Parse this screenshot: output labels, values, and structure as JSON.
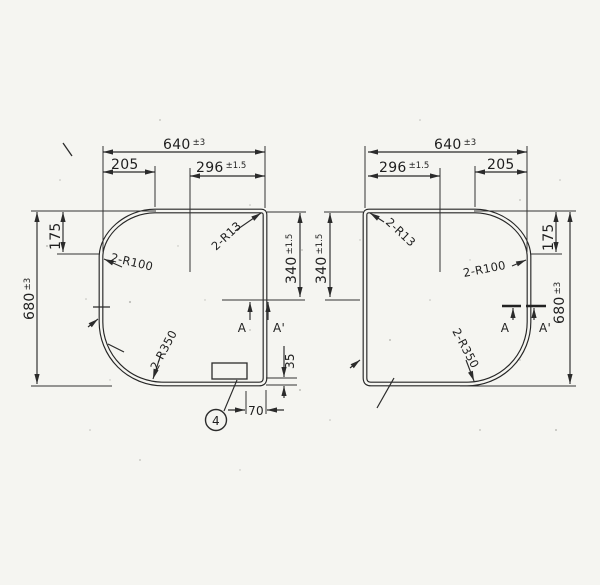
{
  "drawing": {
    "left_view": {
      "dim_width": {
        "value": "640",
        "tol": "±3"
      },
      "dim_left_segment": "205",
      "dim_center_segment": {
        "value": "296",
        "tol": "±1.5"
      },
      "dim_height": {
        "value": "680",
        "tol": "±3"
      },
      "dim_top_edge": "175",
      "dim_right_edge": {
        "value": "340",
        "tol": "±1.5"
      },
      "radius_corner": "2-R13",
      "radius_upper": "2-R100",
      "radius_lower": "2-R350",
      "section_a": "A",
      "section_a_prime": "A'",
      "dim_rim": "35",
      "dim_handle": "70",
      "balloon": "4"
    },
    "right_view": {
      "dim_width": {
        "value": "640",
        "tol": "±3"
      },
      "dim_left_segment": "205",
      "dim_center_segment": {
        "value": "296",
        "tol": "±1.5"
      },
      "dim_height": {
        "value": "680",
        "tol": "±3"
      },
      "dim_top_edge": "175",
      "dim_right_edge": {
        "value": "340",
        "tol": "±1.5"
      },
      "radius_corner": "2-R13",
      "radius_upper": "2-R100",
      "radius_lower": "2-R350",
      "section_a": "A",
      "section_a_prime": "A'"
    }
  }
}
